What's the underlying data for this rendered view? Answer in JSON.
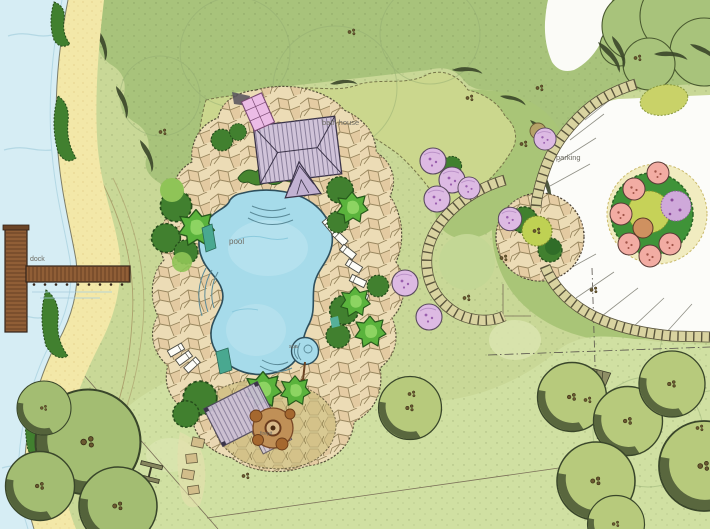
{
  "plan": {
    "labels": [
      {
        "id": "dock",
        "text": "dock"
      },
      {
        "id": "pool",
        "text": "pool"
      },
      {
        "id": "spa",
        "text": "spa"
      },
      {
        "id": "bath-house",
        "text": "bath house"
      },
      {
        "id": "parking",
        "text": "parking"
      },
      {
        "id": "firepit",
        "text": "firepit"
      }
    ],
    "features": [
      "lake",
      "dock",
      "beach",
      "lawn",
      "tree-canopy",
      "shrub-bed",
      "flagstone-pool-deck",
      "swimming-pool",
      "pool-steps",
      "lounge-chairs",
      "spa",
      "bath-house",
      "pergola",
      "firepit-patio",
      "paver-walkway",
      "round-patio",
      "parking-lot",
      "parking-stalls",
      "planting-island",
      "flowering-trees",
      "property-lines"
    ],
    "palette": {
      "paper": "#fcfcf9",
      "water": "#d6edf4",
      "sand": "#f3e8a8",
      "lawn": "#c9d897",
      "canopy": "#a8c37b",
      "meadow": "#cbd78d",
      "lower_lawn": "#d0e0a2",
      "pool_water": "#a6dbea",
      "deck_stone": "#ecdcb6",
      "path_stone": "#d9d3a0",
      "parking": "#fcfcf9",
      "dock_wood": "#905e36",
      "roof": "#d0c3d9",
      "shrub_dark": "#41802f",
      "tree_bright": "#5ab33c",
      "tree_purple": "#ddbae3",
      "tree_pink": "#f2aca3",
      "island_green": "#3f9338",
      "label": "#6e6c63"
    }
  }
}
